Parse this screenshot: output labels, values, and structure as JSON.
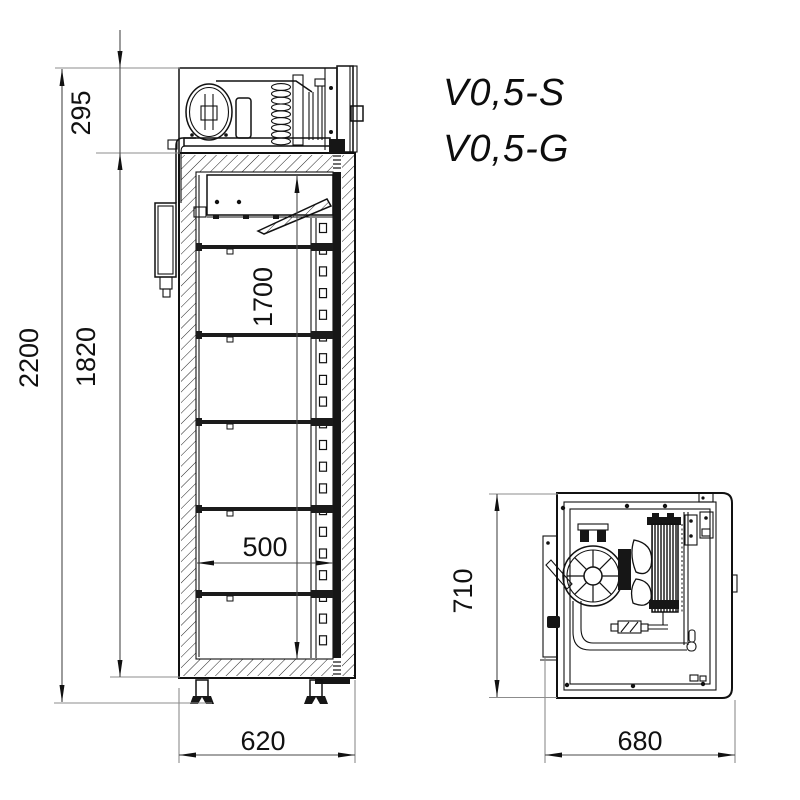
{
  "drawing": {
    "models": {
      "line1": "V0,5-S",
      "line2": "V0,5-G"
    },
    "side_view": {
      "dims": {
        "overall_height": "2200",
        "body_height": "1820",
        "machinery_height": "295",
        "interior_height": "1700",
        "interior_depth": "500",
        "overall_depth": "620"
      }
    },
    "plan_view": {
      "dims": {
        "depth": "710",
        "width": "680"
      }
    },
    "colors": {
      "ink": "#111111",
      "dim_line": "#4a4a4a",
      "witness_line": "#8c8c8c",
      "paper": "#ffffff"
    }
  }
}
